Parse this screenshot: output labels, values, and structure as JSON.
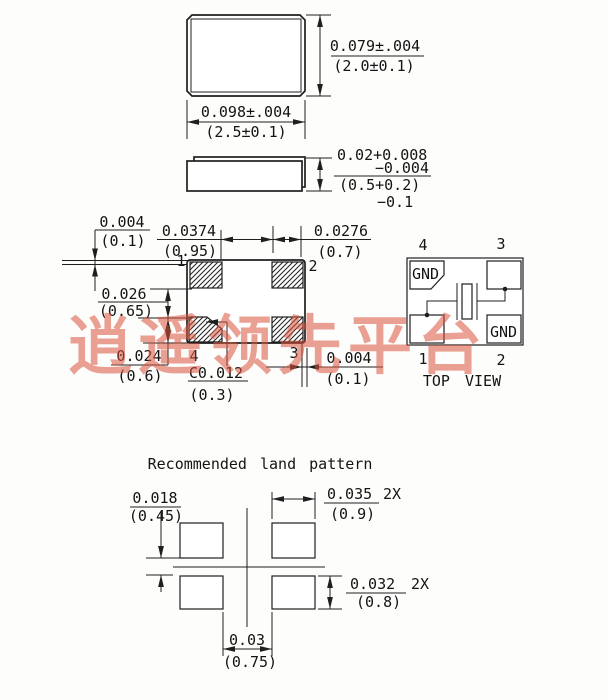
{
  "top_view": {
    "height_in": "0.079±.004",
    "height_mm": "(2.0±0.1)",
    "width_in": "0.098±.004",
    "width_mm": "(2.5±0.1)"
  },
  "side_view": {
    "thick_in_1": "0.02+0.008",
    "thick_in_2": "−0.004",
    "thick_mm_1": "(0.5+0.2)",
    "thick_mm_2": "−0.1"
  },
  "bottom_view": {
    "pin1": "1",
    "pin2": "2",
    "pin3": "3",
    "pin4": "4",
    "offset_top_in": "0.004",
    "offset_top_mm": "(0.1)",
    "gap_x_in": "0.0374",
    "gap_x_mm": "(0.95)",
    "pad_w_in": "0.0276",
    "pad_w_mm": "(0.7)",
    "gap_y_in": "0.026",
    "gap_y_mm": "(0.65)",
    "pad_h_in": "0.024",
    "pad_h_mm": "(0.6)",
    "chamfer_in": "C0.012",
    "chamfer_mm": "(0.3)",
    "offset_right_in": "0.004",
    "offset_right_mm": "(0.1)"
  },
  "schematic": {
    "pin1": "1",
    "pin2": "2",
    "pin3": "3",
    "pin4": "4",
    "gnd_top": "GND",
    "gnd_bottom": "GND",
    "caption": "TOP VIEW"
  },
  "land_pattern": {
    "title": "Recommended land pattern",
    "row_gap_in": "0.018",
    "row_gap_mm": "(0.45)",
    "pad_w_in": "0.035",
    "pad_w_qty": "2X",
    "pad_w_mm": "(0.9)",
    "pad_h_in": "0.032",
    "pad_h_qty": "2X",
    "pad_h_mm": "(0.8)",
    "col_gap_in": "0.03",
    "col_gap_mm": "(0.75)"
  },
  "watermark": {
    "text": "逍遥领先平台",
    "color": "#d9543c"
  },
  "colors": {
    "line": "#1f1f1f",
    "background": "#fdfdfc"
  }
}
